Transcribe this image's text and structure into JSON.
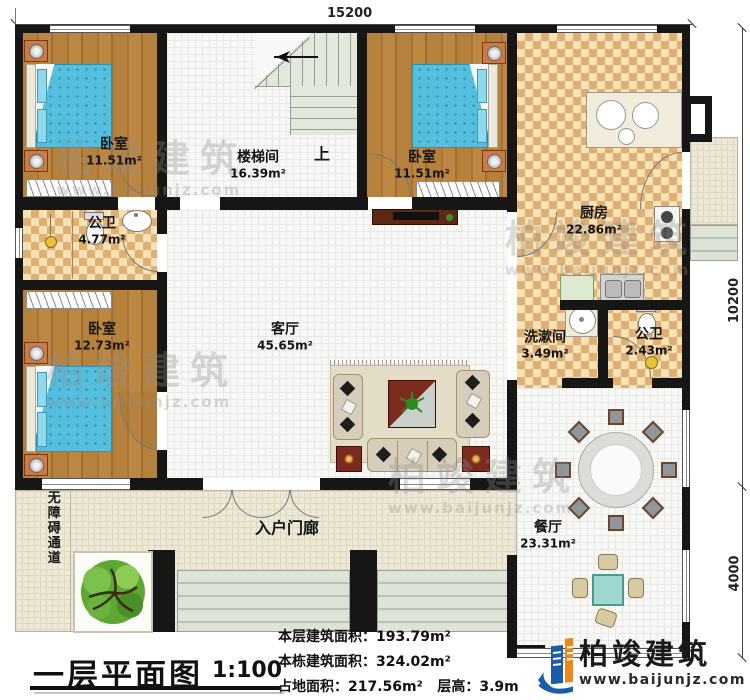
{
  "dimensions": {
    "top": "15200",
    "right_upper": "10200",
    "right_lower": "4000"
  },
  "rooms": {
    "bedroom1": {
      "name": "卧室",
      "area": "11.51m²"
    },
    "stairwell": {
      "name": "楼梯间",
      "area": "16.39m²",
      "up": "上"
    },
    "bedroom2": {
      "name": "卧室",
      "area": "11.51m²"
    },
    "kitchen": {
      "name": "厨房",
      "area": "22.86m²"
    },
    "bathroom1": {
      "name": "公卫",
      "area": "4.77m²"
    },
    "bedroom3": {
      "name": "卧室",
      "area": "12.73m²"
    },
    "living": {
      "name": "客厅",
      "area": "45.65m²"
    },
    "washroom": {
      "name": "洗漱间",
      "area": "3.49m²"
    },
    "bathroom2": {
      "name": "公卫",
      "area": "2.43m²"
    },
    "dining": {
      "name": "餐厅",
      "area": "23.31m²"
    },
    "porch": {
      "name": "入户门廊"
    },
    "ramp": {
      "name": "无障碍通道"
    }
  },
  "title_block": {
    "title": "一层平面图",
    "scale": "1:100",
    "stats": [
      {
        "label": "本层建筑面积：",
        "value": "193.79m²"
      },
      {
        "label": "本栋建筑面积：",
        "value": "324.02m²"
      },
      {
        "label": "占地面积：",
        "value": "217.56m²"
      },
      {
        "label": "层高：",
        "value": "3.9m"
      }
    ]
  },
  "brand": {
    "name": "柏竣建筑",
    "url": "www.baijunjz.com"
  },
  "watermark": {
    "text": "柏竣建筑",
    "url": "www.baijunjz.com"
  },
  "colors": {
    "wall": "#161616",
    "wood_floor": "#b07c3e",
    "checker_dark": "#e0af74",
    "checker_light": "#f6e2b4",
    "bed_blue": "#55bedd",
    "table_teal": "#9ed8d0",
    "logo_blue": "#1b5ca8",
    "logo_orange": "#f08519"
  }
}
